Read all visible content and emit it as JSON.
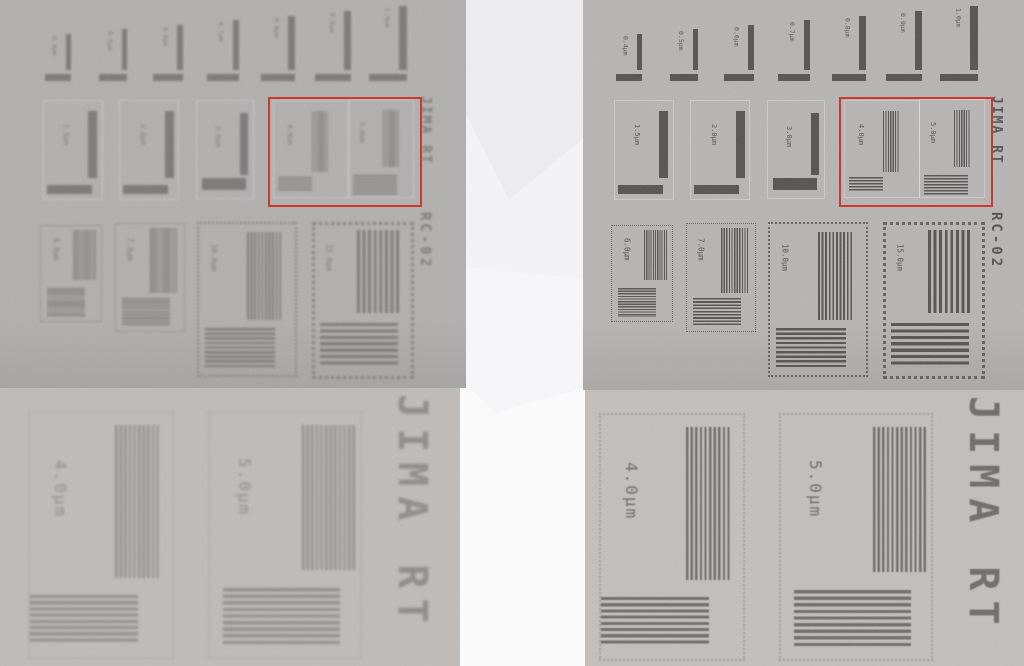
{
  "figure": {
    "description_left": "blurred radiograph",
    "description_right": "sharp radiograph"
  },
  "test_chart": {
    "vertical_title_upper": "JIMA RT",
    "vertical_title_lower": "RC-02",
    "row1_labels": [
      "0.4μm",
      "0.5μm",
      "0.6μm",
      "0.7μm",
      "0.8μm",
      "0.9μm",
      "1.0μm"
    ],
    "row2_labels": [
      "1.5μm",
      "2.0μm",
      "3.0μm",
      "4.0μm",
      "5.0μm"
    ],
    "row3_labels": [
      "6.0μm",
      "7.0μm",
      "10.0μm",
      "15.0μm"
    ]
  },
  "zoom_view": {
    "vertical_title": "JIMA RT",
    "labels": [
      "4.0μm",
      "5.0μm"
    ]
  },
  "colors": {
    "highlight_red": "#cc3a2e",
    "panel_bg_top_left": "#b2b0ae",
    "panel_bg_top_left_bottom": "#a6a4a2",
    "pattern_top_left": "#7b7876",
    "panel_bg_top_right": "#b7b5b3",
    "panel_bg_top_right_bottom": "#aaa8a6",
    "pattern_top_right": "#545250",
    "panel_bg_bottom_left": "#bfbcb9",
    "pattern_bottom_left": "#8e8b88",
    "panel_bg_bottom_right": "#c2bfbc",
    "pattern_bottom_right": "#6e6b68",
    "gap_bg": "#fbfbfc"
  }
}
